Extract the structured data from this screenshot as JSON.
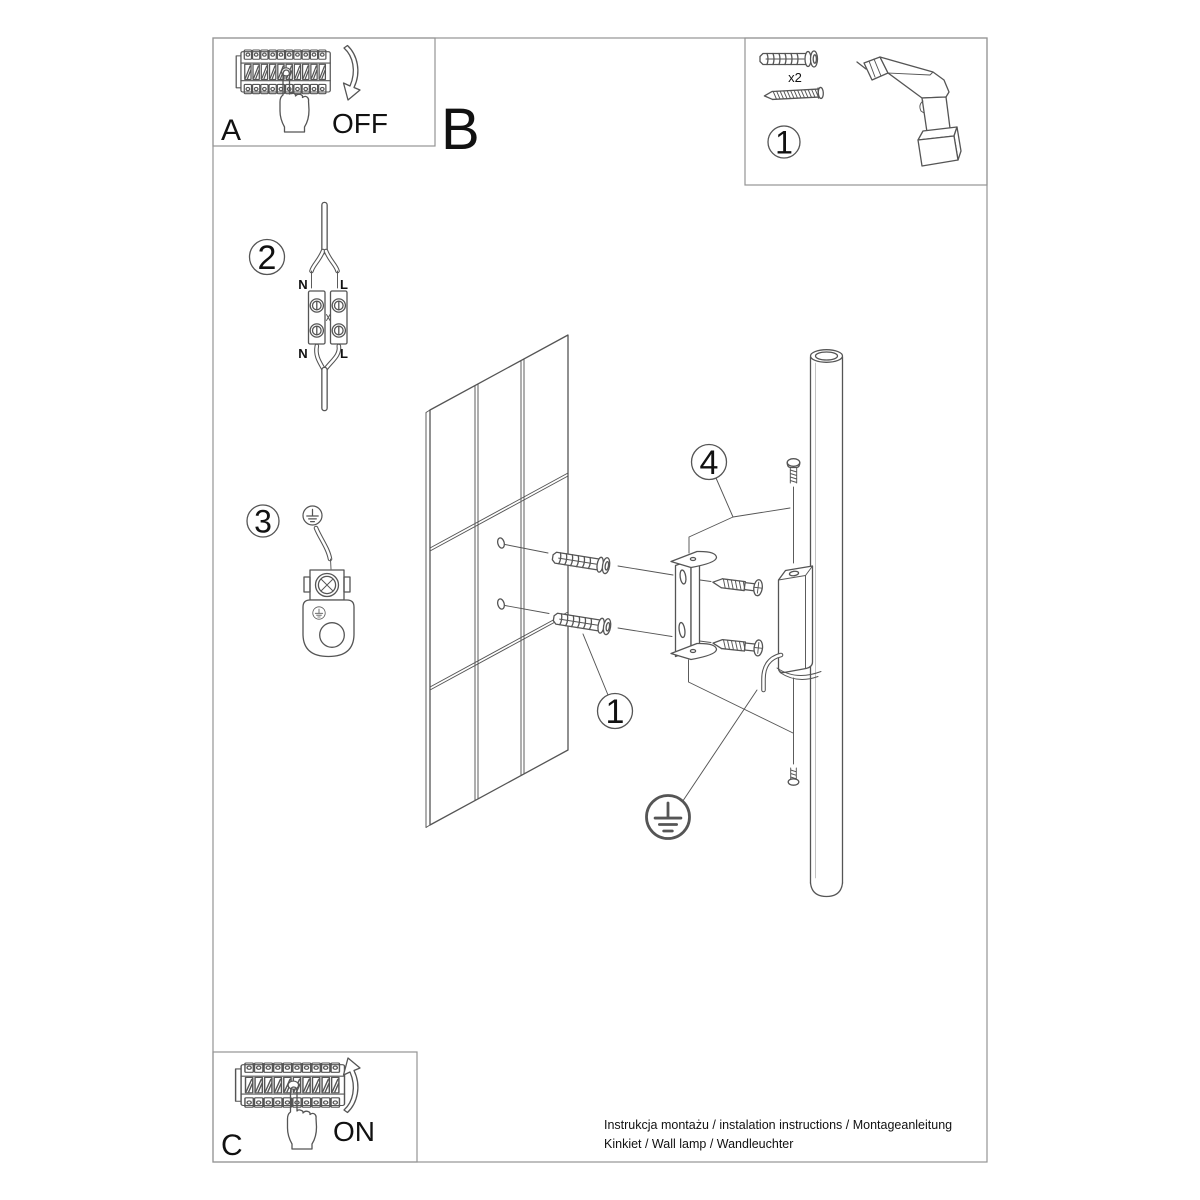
{
  "colors": {
    "background": "#ffffff",
    "line": "#555555",
    "frame": "#949494",
    "text": "#111111"
  },
  "frame": {
    "letter_b": "B"
  },
  "box_a": {
    "letter": "A",
    "state_label": "OFF",
    "icons": [
      "circuit-breaker-panel",
      "hand-pressing-switch",
      "curved-arrow-down"
    ]
  },
  "box_c": {
    "letter": "C",
    "state_label": "ON",
    "icons": [
      "circuit-breaker-panel",
      "hand-pressing-switch",
      "curved-arrow-up"
    ]
  },
  "parts_box": {
    "callout_number": "1",
    "anchor_quantity_label": "x2",
    "icons": [
      "wall-plug",
      "screw",
      "cordless-drill"
    ]
  },
  "step_wiring": {
    "callout_number": "2",
    "terminal_labels": {
      "top_left": "N",
      "top_right": "L",
      "bottom_left": "N",
      "bottom_right": "L"
    }
  },
  "step_ground": {
    "callout_number": "3",
    "icon": "protective-earth-symbol"
  },
  "main_diagram": {
    "callout_drill_anchors": "1",
    "callout_mounting": "4",
    "icons": [
      "tiled-wall",
      "wall-plug",
      "mounting-bracket",
      "mounting-screws",
      "lamp-tube",
      "protective-earth-symbol"
    ]
  },
  "footer": {
    "line1": "Instrukcja montażu / instalation instructions / Montageanleitung",
    "line2": "Kinkiet / Wall lamp / Wandleuchter"
  }
}
